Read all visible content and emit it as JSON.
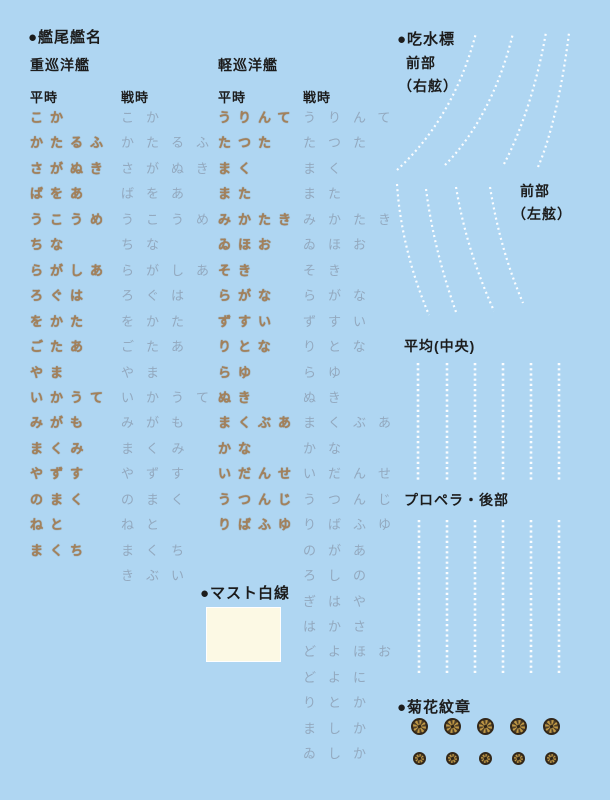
{
  "stern_names": {
    "title": "●艦尾艦名",
    "heavy": {
      "label": "重巡洋艦",
      "col_peace": "平時",
      "col_war": "戦時",
      "peace": [
        "こか",
        "かたるふ",
        "さがぬき",
        "ばをあ",
        "うこうめ",
        "ちな",
        "らがしあ",
        "ろぐは",
        "をかた",
        "ごたあ",
        "やま",
        "いかうて",
        "みがも",
        "まくみ",
        "やずす",
        "のまく",
        "ねと",
        "まくち"
      ],
      "war": [
        "こか",
        "かたるふ",
        "さがぬき",
        "ばをあ",
        "うこうめ",
        "ちな",
        "らがしあ",
        "ろぐは",
        "をかた",
        "ごたあ",
        "やま",
        "いかうて",
        "みがも",
        "まくみ",
        "やずす",
        "のまく",
        "ねと",
        "まくち",
        "きぶい"
      ]
    },
    "light": {
      "label": "軽巡洋艦",
      "col_peace": "平時",
      "col_war": "戦時",
      "peace": [
        "うりんて",
        "たつた",
        "まく",
        "また",
        "みかたき",
        "ゐほお",
        "そき",
        "らがな",
        "ずすい",
        "りとな",
        "らゆ",
        "ぬき",
        "まくぶあ",
        "かな",
        "いだんせ",
        "うつんじ",
        "りばふゆ"
      ],
      "war": [
        "うりんて",
        "たつた",
        "まく",
        "また",
        "みかたき",
        "ゐほお",
        "そき",
        "らがな",
        "ずすい",
        "りとな",
        "らゆ",
        "ぬき",
        "まくぶあ",
        "かな",
        "いだんせ",
        "うつんじ",
        "りばふゆ",
        "のがあ",
        "ろしの",
        "ぎはや",
        "はかさ",
        "どよほお",
        "どよに",
        "りとか",
        "ましか",
        "ゐしか"
      ]
    }
  },
  "mast_line": {
    "title": "●マスト白線",
    "swatch_color": "#FCF9E4"
  },
  "draft_marks": {
    "title": "●吃水標",
    "front_label": "前部",
    "front_starboard": "（右舷）",
    "front_port_label": "前部",
    "front_port": "（左舷）",
    "middle": "平均(中央)",
    "propeller_stern": "プロペラ・後部",
    "mark_color": "#ffffff"
  },
  "crest": {
    "title": "●菊花紋章",
    "rows": [
      {
        "count": 5,
        "size": 17
      },
      {
        "count": 5,
        "size": 13
      }
    ],
    "gold": "#bf9845",
    "dark": "#33281a"
  },
  "colors": {
    "background": "#AFD6F2",
    "peacetime_gold": "#a4815a",
    "wartime_gray": "#93a9bf",
    "text": "#1c1c1c"
  }
}
